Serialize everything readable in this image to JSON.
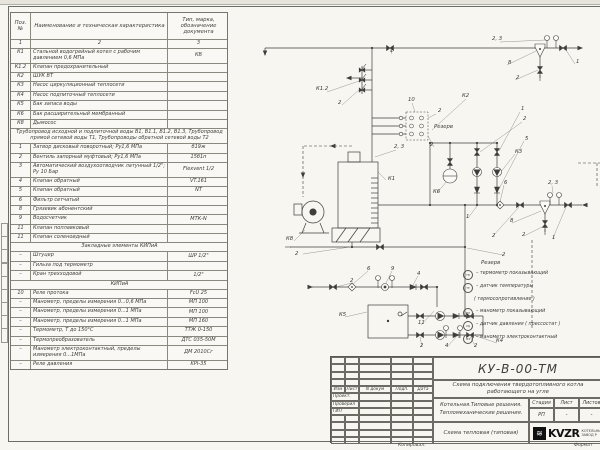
{
  "page": {
    "copied_label": "Копировал:",
    "format_label": "Формат"
  },
  "spec_table": {
    "headers": {
      "pos": "Поз. №",
      "name": "Наименование и техническая характеристика",
      "type": "Тип, марка, обозначение документа"
    },
    "col_numbers": [
      "1",
      "2",
      "3"
    ],
    "rows": [
      {
        "kind": "item",
        "pos": "К1",
        "name": "Стальной водогрейный котел с рабочим давлением 0,6 МПа",
        "type": "КВ"
      },
      {
        "kind": "item",
        "pos": "К1.2",
        "name": "Клапан предохранительный",
        "type": ""
      },
      {
        "kind": "item",
        "pos": "К2",
        "name": "ШУК ВТ",
        "type": ""
      },
      {
        "kind": "item",
        "pos": "К3",
        "name": "Насос циркуляционный теплосети",
        "type": ""
      },
      {
        "kind": "item",
        "pos": "К4",
        "name": "Насос подпиточный теплосети",
        "type": ""
      },
      {
        "kind": "item",
        "pos": "К5",
        "name": "Бак запаса воды",
        "type": ""
      },
      {
        "kind": "item",
        "pos": "К6",
        "name": "Бак расширительный мембранный",
        "type": ""
      },
      {
        "kind": "item",
        "pos": "К8",
        "name": "Дымосос",
        "type": ""
      },
      {
        "kind": "note",
        "name": "Трубопровод исходной и подпиточной воды В1, В1.1, В1.2, В1.3, Трубопровод прямой сетевой воды Т1, Трубопроводы обратной сетевой воды Т2"
      },
      {
        "kind": "item",
        "pos": "1",
        "name": "Затвор дисковый поворотный; Ру1,6 МПа",
        "type": "б19ж"
      },
      {
        "kind": "item",
        "pos": "2",
        "name": "Вентиль запорный муфтовый; Ру1,6 МПа",
        "type": "15б1п"
      },
      {
        "kind": "item",
        "pos": "3",
        "name": "Автоматический воздухоотводчик латунный 1/2\"; Ру 10 Бар",
        "type": "Flexvent 1/2"
      },
      {
        "kind": "item",
        "pos": "4",
        "name": "Клапан обратный",
        "type": "VT.161"
      },
      {
        "kind": "item",
        "pos": "5",
        "name": "Клапан обратный",
        "type": "NT"
      },
      {
        "kind": "item",
        "pos": "6",
        "name": "Фильтр сетчатый",
        "type": ""
      },
      {
        "kind": "item",
        "pos": "8",
        "name": "Грязевик абонентский",
        "type": ""
      },
      {
        "kind": "item",
        "pos": "9",
        "name": "Водосчетчик",
        "type": "МТК-N"
      },
      {
        "kind": "item",
        "pos": "11",
        "name": "Клапан поплавковый",
        "type": ""
      },
      {
        "kind": "item",
        "pos": "11",
        "name": "Клапан соленоидный",
        "type": ""
      },
      {
        "kind": "sect",
        "name": "Закладные элементы КИПиА"
      },
      {
        "kind": "item",
        "pos": "–",
        "name": "Штуцер",
        "type": "ШР 1/2\""
      },
      {
        "kind": "item",
        "pos": "–",
        "name": "Гильза под термометр",
        "type": ""
      },
      {
        "kind": "item",
        "pos": "–",
        "name": "Кран трехходовой",
        "type": "1/2\""
      },
      {
        "kind": "sect",
        "name": "КИПиА"
      },
      {
        "kind": "item",
        "pos": "10",
        "name": "Реле протока",
        "type": "FcU 25"
      },
      {
        "kind": "item",
        "pos": "–",
        "name": "Манометр, пределы измерения 0...0,6 МПа",
        "type": "МП 100"
      },
      {
        "kind": "item",
        "pos": "–",
        "name": "Манометр, пределы измерения 0...1 МПа",
        "type": "МП 100"
      },
      {
        "kind": "item",
        "pos": "–",
        "name": "Манометр, пределы измерения 0...1 МПа",
        "type": "МП 160"
      },
      {
        "kind": "item",
        "pos": "–",
        "name": "Термометр, Т до 150°С",
        "type": "ТТЖ 0-150"
      },
      {
        "kind": "item",
        "pos": "–",
        "name": "Термопреобразователь",
        "type": "ДТС 035-50М"
      },
      {
        "kind": "item",
        "pos": "–",
        "name": "Манометр электроконтактный, пределы измерения 0...1МПа",
        "type": "ДМ 2010Сг"
      },
      {
        "kind": "item",
        "pos": "–",
        "name": "Реле давления",
        "type": "KPI-35"
      }
    ]
  },
  "legend": {
    "title": "Резерв",
    "items": [
      {
        "sym": "ТВ",
        "text": "– термометр показывающий"
      },
      {
        "sym": "ТЕ",
        "text": "– датчик температуры"
      },
      {
        "sym": null,
        "text": "( термосопротивление )"
      },
      {
        "sym": "МН",
        "text": "– манометр показывающий"
      },
      {
        "sym": "РД",
        "text": "– датчик давления ( прессостат )"
      },
      {
        "sym": "МЭ",
        "text": "– манометр электроконтактный"
      }
    ]
  },
  "schematic": {
    "pipes": [
      [
        265,
        48,
        578,
        48
      ],
      [
        265,
        48,
        265,
        53
      ],
      [
        372,
        48,
        372,
        162
      ],
      [
        362,
        66,
        362,
        94
      ],
      [
        362,
        70,
        372,
        70
      ],
      [
        362,
        80,
        372,
        80
      ],
      [
        362,
        90,
        372,
        90
      ],
      [
        348,
        78,
        362,
        78
      ],
      [
        430,
        143,
        497,
        143
      ],
      [
        430,
        143,
        430,
        205
      ],
      [
        477,
        143,
        477,
        205
      ],
      [
        497,
        143,
        497,
        205
      ],
      [
        378,
        205,
        582,
        205
      ],
      [
        450,
        143,
        450,
        169
      ],
      [
        352,
        242,
        352,
        247
      ],
      [
        290,
        247,
        465,
        247
      ],
      [
        465,
        205,
        465,
        316
      ],
      [
        310,
        287,
        437,
        287
      ],
      [
        437,
        287,
        437,
        307
      ],
      [
        408,
        316,
        483,
        316
      ],
      [
        408,
        335,
        483,
        335
      ],
      [
        483,
        316,
        483,
        335
      ],
      [
        540,
        54,
        540,
        78
      ],
      [
        545,
        213,
        545,
        232
      ],
      [
        372,
        118,
        406,
        118
      ],
      [
        372,
        126,
        406,
        126
      ],
      [
        372,
        134,
        406,
        134
      ]
    ],
    "dashed": [
      [
        352,
        146,
        303,
        146
      ],
      [
        303,
        146,
        303,
        197
      ],
      [
        578,
        163,
        600,
        163
      ],
      [
        597,
        163,
        597,
        188
      ],
      [
        532,
        240,
        532,
        330
      ]
    ],
    "leaders": [
      [
        327,
        92,
        362,
        80
      ],
      [
        342,
        105,
        360,
        89
      ],
      [
        392,
        54,
        390,
        49
      ],
      [
        386,
        180,
        378,
        172
      ],
      [
        294,
        241,
        305,
        230
      ],
      [
        303,
        254,
        350,
        247
      ],
      [
        412,
        103,
        415,
        112
      ],
      [
        436,
        114,
        428,
        118
      ],
      [
        434,
        147,
        428,
        136
      ],
      [
        466,
        99,
        432,
        130
      ],
      [
        520,
        112,
        499,
        151
      ],
      [
        522,
        122,
        480,
        152
      ],
      [
        524,
        141,
        499,
        189
      ],
      [
        515,
        154,
        500,
        173
      ],
      [
        437,
        193,
        447,
        181
      ],
      [
        504,
        185,
        500,
        202
      ],
      [
        500,
        42,
        546,
        40
      ],
      [
        507,
        65,
        536,
        51
      ],
      [
        515,
        80,
        538,
        70
      ],
      [
        575,
        64,
        566,
        50
      ],
      [
        552,
        186,
        553,
        193
      ],
      [
        553,
        238,
        566,
        207
      ],
      [
        468,
        218,
        477,
        206
      ],
      [
        493,
        236,
        519,
        207
      ],
      [
        512,
        223,
        541,
        211
      ],
      [
        524,
        236,
        544,
        226
      ],
      [
        503,
        255,
        467,
        248
      ],
      [
        352,
        283,
        336,
        287
      ],
      [
        368,
        271,
        353,
        284
      ],
      [
        392,
        271,
        386,
        283
      ],
      [
        418,
        276,
        413,
        285
      ],
      [
        345,
        317,
        367,
        312
      ],
      [
        421,
        325,
        434,
        311
      ],
      [
        422,
        347,
        420,
        337
      ],
      [
        447,
        347,
        456,
        337
      ],
      [
        476,
        347,
        470,
        337
      ],
      [
        497,
        343,
        473,
        335
      ],
      [
        396,
        150,
        375,
        157
      ]
    ],
    "symbols": [
      [
        "v",
        390,
        48,
        0
      ],
      [
        "v",
        563,
        48,
        0
      ],
      [
        "v",
        540,
        70,
        90
      ],
      [
        "v",
        520,
        205,
        0
      ],
      [
        "v",
        568,
        205,
        0
      ],
      [
        "v",
        545,
        224,
        90
      ],
      [
        "v",
        477,
        152,
        90
      ],
      [
        "v",
        497,
        152,
        90
      ],
      [
        "v",
        450,
        162,
        90
      ],
      [
        "v",
        380,
        247,
        0
      ],
      [
        "v",
        333,
        287,
        0
      ],
      [
        "v",
        424,
        287,
        0
      ],
      [
        "v",
        420,
        316,
        0
      ],
      [
        "v",
        470,
        316,
        0
      ],
      [
        "v",
        420,
        335,
        0
      ],
      [
        "v",
        470,
        335,
        0
      ],
      [
        "p",
        477,
        172,
        90
      ],
      [
        "p",
        497,
        172,
        90
      ],
      [
        "p",
        440,
        316,
        0
      ],
      [
        "p",
        440,
        335,
        0
      ],
      [
        "c",
        477,
        190,
        90
      ],
      [
        "c",
        497,
        190,
        90
      ],
      [
        "c",
        413,
        287,
        0
      ],
      [
        "c",
        456,
        316,
        0
      ],
      [
        "c",
        456,
        335,
        0
      ],
      [
        "g",
        540,
        48,
        0
      ],
      [
        "g",
        545,
        205,
        0
      ],
      [
        "m",
        547,
        38,
        0
      ],
      [
        "m",
        556,
        38,
        0
      ],
      [
        "m",
        550,
        195,
        0
      ],
      [
        "m",
        559,
        195,
        0
      ],
      [
        "m",
        378,
        278,
        0
      ],
      [
        "m",
        392,
        278,
        0
      ],
      [
        "m",
        446,
        328,
        0
      ],
      [
        "m",
        460,
        328,
        0
      ],
      [
        "f",
        352,
        287,
        0
      ],
      [
        "f",
        500,
        205,
        0
      ],
      [
        "w",
        385,
        287,
        0
      ],
      [
        "e",
        450,
        176,
        0
      ],
      [
        "s",
        362,
        70,
        0
      ],
      [
        "s",
        362,
        80,
        0
      ],
      [
        "s",
        362,
        90,
        0
      ],
      [
        "o",
        401,
        118,
        0
      ],
      [
        "o",
        401,
        126,
        0
      ],
      [
        "o",
        401,
        134,
        0
      ],
      [
        "x",
        288,
        247,
        0
      ],
      [
        "x",
        540,
        78,
        90
      ],
      [
        "x",
        545,
        232,
        90
      ]
    ],
    "dots": [
      [
        372,
        48
      ],
      [
        430,
        143
      ],
      [
        450,
        143
      ],
      [
        477,
        143
      ],
      [
        497,
        143
      ],
      [
        430,
        205
      ],
      [
        465,
        205
      ],
      [
        477,
        205
      ],
      [
        497,
        205
      ],
      [
        465,
        247
      ],
      [
        465,
        316
      ],
      [
        352,
        247
      ],
      [
        437,
        287
      ]
    ],
    "arrows": [
      [
        583,
        48,
        "r"
      ],
      [
        582,
        205,
        "l"
      ],
      [
        346,
        78,
        "l"
      ],
      [
        265,
        56,
        "d"
      ],
      [
        330,
        146,
        "l"
      ],
      [
        303,
        178,
        "d"
      ],
      [
        313,
        287,
        "r"
      ]
    ],
    "labels": [
      [
        "1",
        390,
        52
      ],
      [
        "2, 3",
        492,
        40
      ],
      [
        "8",
        508,
        64
      ],
      [
        "2",
        516,
        79
      ],
      [
        "1",
        576,
        63
      ],
      [
        "К1.2",
        316,
        90
      ],
      [
        "2",
        338,
        104
      ],
      [
        "2, 3",
        394,
        148
      ],
      [
        "К1",
        388,
        180
      ],
      [
        "10",
        408,
        101
      ],
      [
        "Резерв",
        434,
        128
      ],
      [
        "2",
        438,
        112
      ],
      [
        "2",
        430,
        146
      ],
      [
        "К2",
        462,
        97
      ],
      [
        "1",
        521,
        110
      ],
      [
        "2",
        523,
        120
      ],
      [
        "5",
        525,
        140
      ],
      [
        "К3",
        515,
        153
      ],
      [
        "К6",
        433,
        193
      ],
      [
        "6",
        504,
        184
      ],
      [
        "2, 3",
        548,
        184
      ],
      [
        "1",
        552,
        239
      ],
      [
        "1",
        466,
        218
      ],
      [
        "2",
        492,
        237
      ],
      [
        "8",
        510,
        222
      ],
      [
        "2",
        522,
        236
      ],
      [
        "2",
        502,
        256
      ],
      [
        "К8",
        286,
        240
      ],
      [
        "2",
        295,
        255
      ],
      [
        "2",
        350,
        282
      ],
      [
        "6",
        367,
        270
      ],
      [
        "9",
        391,
        270
      ],
      [
        "4",
        417,
        275
      ],
      [
        "К5",
        339,
        316
      ],
      [
        "11",
        418,
        324
      ],
      [
        "2",
        420,
        347
      ],
      [
        "4",
        445,
        347
      ],
      [
        "2",
        474,
        347
      ],
      [
        "К4",
        496,
        342
      ]
    ],
    "equipment": {
      "boiler": [
        338,
        152
      ],
      "fan": [
        313,
        212
      ],
      "tank": [
        368,
        305
      ],
      "reserve_box": [
        406,
        112
      ]
    }
  },
  "title_block": {
    "doc_code": "КУ-В-00-ТМ",
    "doc_title": "Схема подключения твердотопливного котла работающего на угле",
    "object_line1": "Котельная.Типовые решения.",
    "object_line2": "Тепломеханические решения.",
    "sheet_name": "Схема тепловая (типовая)",
    "stage_label": "Стадия",
    "sheet_label": "Лист",
    "sheets_label": "Листов",
    "stage_value": "РП",
    "sheet_value": "-",
    "sheets_value": "-",
    "rev_headers": [
      "Изм",
      "Лист",
      "N докум",
      "Подп.",
      "Дата"
    ],
    "sign_rows": [
      "Проект.",
      "Проверил",
      "ГИП"
    ],
    "logo_text": "KVZR",
    "logo_icon": "≋",
    "logo_caption1": "КОТЕЛЬНЫЙ",
    "logo_caption2": "ЗАВОД Р"
  }
}
